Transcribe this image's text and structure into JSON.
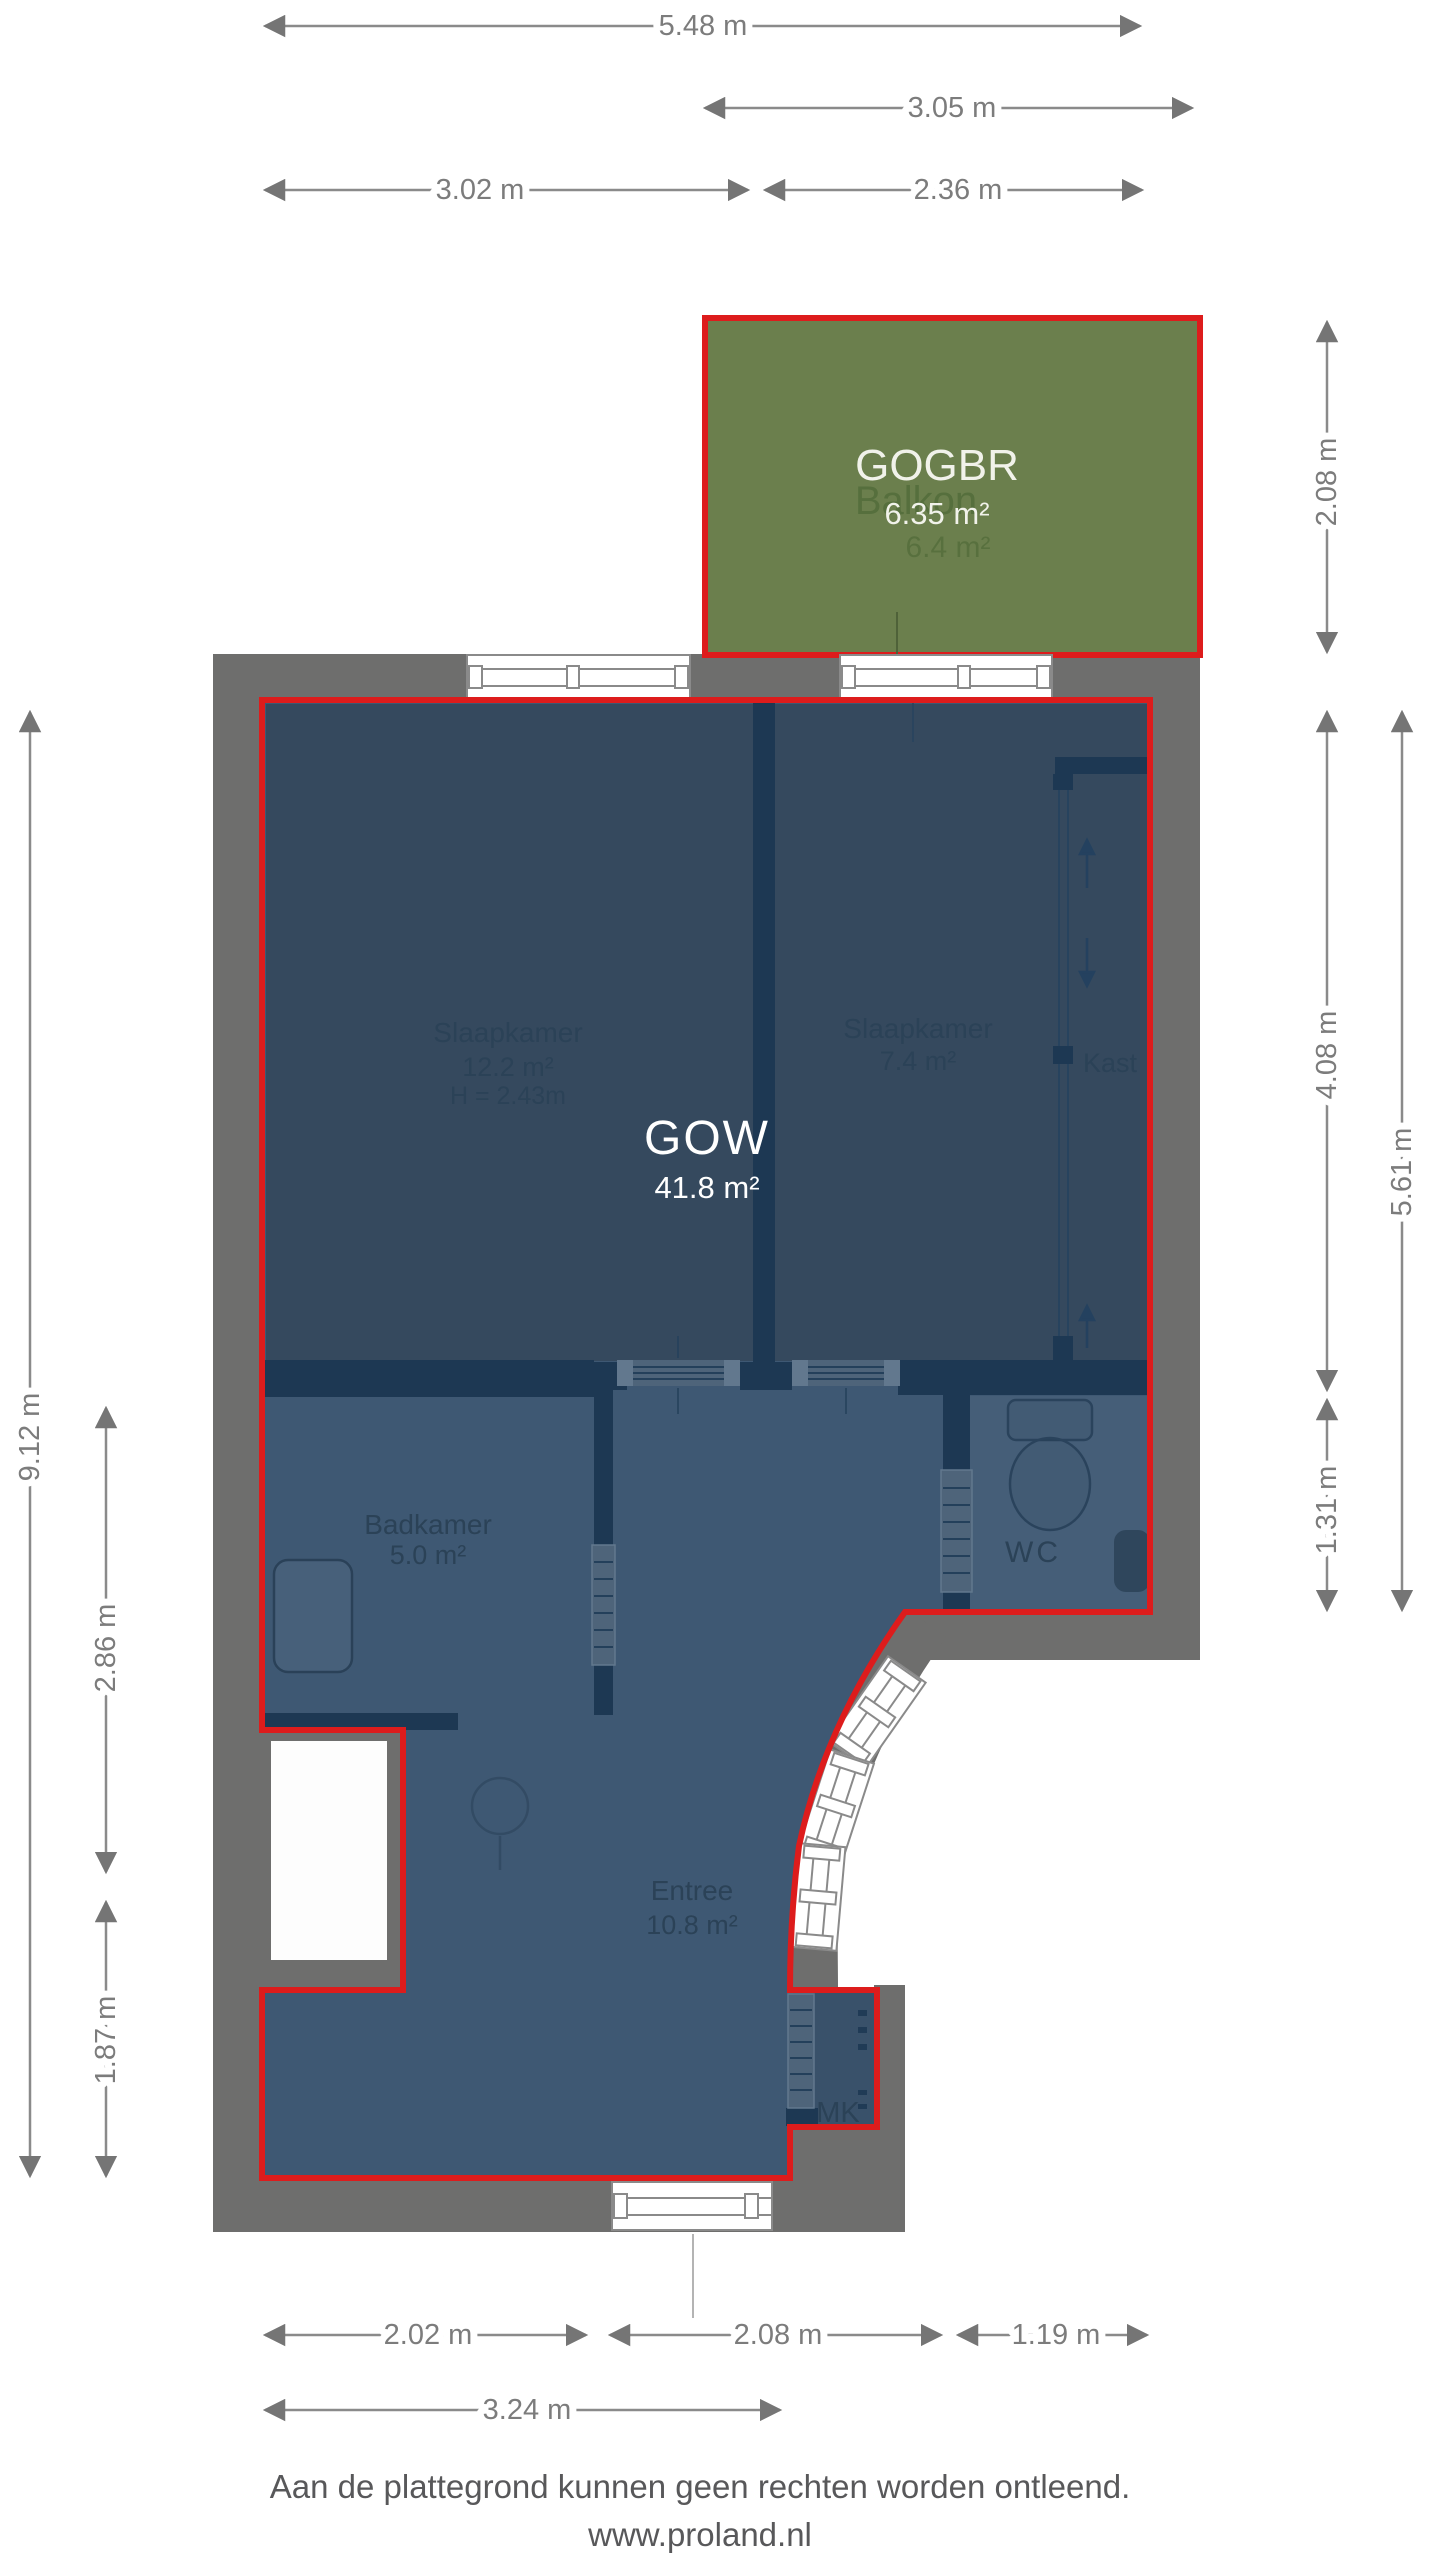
{
  "plan": {
    "title": "plattegrond",
    "rooms": {
      "gogbr": {
        "name": "GOGBR",
        "area": "6.35 m²",
        "ghost_name": "Balkon",
        "ghost_area": "6.4 m²"
      },
      "gow": {
        "name": "GOW",
        "area": "41.8 m²"
      },
      "slaapkamer1": {
        "name": "Slaapkamer",
        "area": "12.2 m²",
        "ceiling_height": "H = 2.43m"
      },
      "slaapkamer2": {
        "name": "Slaapkamer",
        "area": "7.4 m²"
      },
      "kast": {
        "name": "Kast"
      },
      "badkamer": {
        "name": "Badkamer",
        "area": "5.0 m²"
      },
      "wc": {
        "name": "WC"
      },
      "entree": {
        "name": "Entree",
        "area": "10.8 m²"
      },
      "mk": {
        "name": "MK"
      }
    },
    "dimensions": {
      "top": [
        "5.48 m",
        "3.05 m",
        "3.02 m",
        "2.36 m"
      ],
      "left": [
        "9.12 m",
        "2.86 m",
        "1.87 m"
      ],
      "right": [
        "2.08 m",
        "4.08 m",
        "5.61 m",
        "1.31 m"
      ],
      "bottom": [
        "2.02 m",
        "2.08 m",
        "1.19 m",
        "3.24 m"
      ]
    },
    "footer": {
      "disclaimer": "Aan de plattegrond kunnen geen rechten worden ontleend.",
      "website": "www.proland.nl"
    },
    "colors": {
      "wall_gray": "#6e6e6d",
      "room_dark_blue": "#35495e",
      "room_light_blue": "#3e5873",
      "inner_wall_navy": "#1d3853",
      "boundary_red": "#dd1c1c",
      "balcony_green": "#6b7f4d",
      "dimension_gray": "#7c7c7c"
    }
  }
}
